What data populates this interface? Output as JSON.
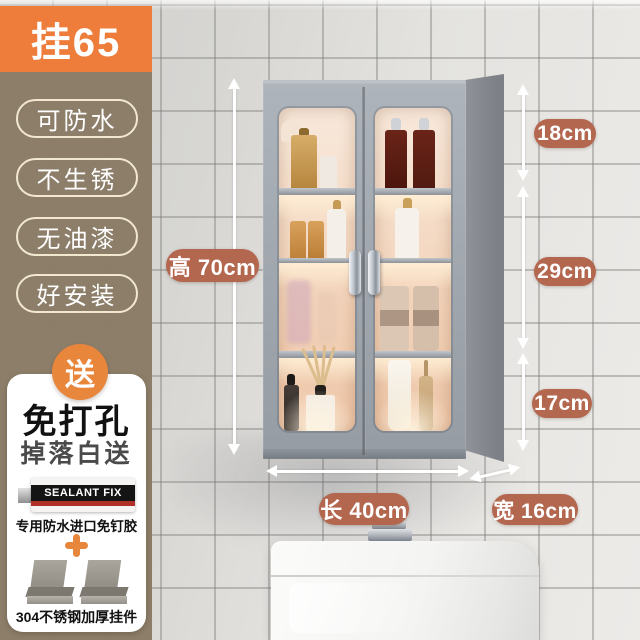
{
  "badge": {
    "label": "挂65"
  },
  "features": [
    {
      "label": "可防水"
    },
    {
      "label": "不生锈"
    },
    {
      "label": "无油漆"
    },
    {
      "label": "好安装"
    }
  ],
  "gift": {
    "badge_label": "送",
    "title": "免打孔",
    "subtitle": "掉落白送",
    "glue_brand": "SEALANT FIX",
    "glue_caption": "专用防水进口免钉胶",
    "brackets_caption": "304不锈钢加厚挂件"
  },
  "dimensions": {
    "height_label": "高 70cm",
    "section_top": "18cm",
    "section_middle": "29cm",
    "section_bottom": "17cm",
    "length_label": "长 40cm",
    "depth_label": "宽 16cm"
  },
  "colors": {
    "accent_orange": "#EE7D3B",
    "panel_brown": "#8A7B66",
    "dimension_pill": "#B4674F",
    "cabinet_gray": "#9CA3AB"
  }
}
